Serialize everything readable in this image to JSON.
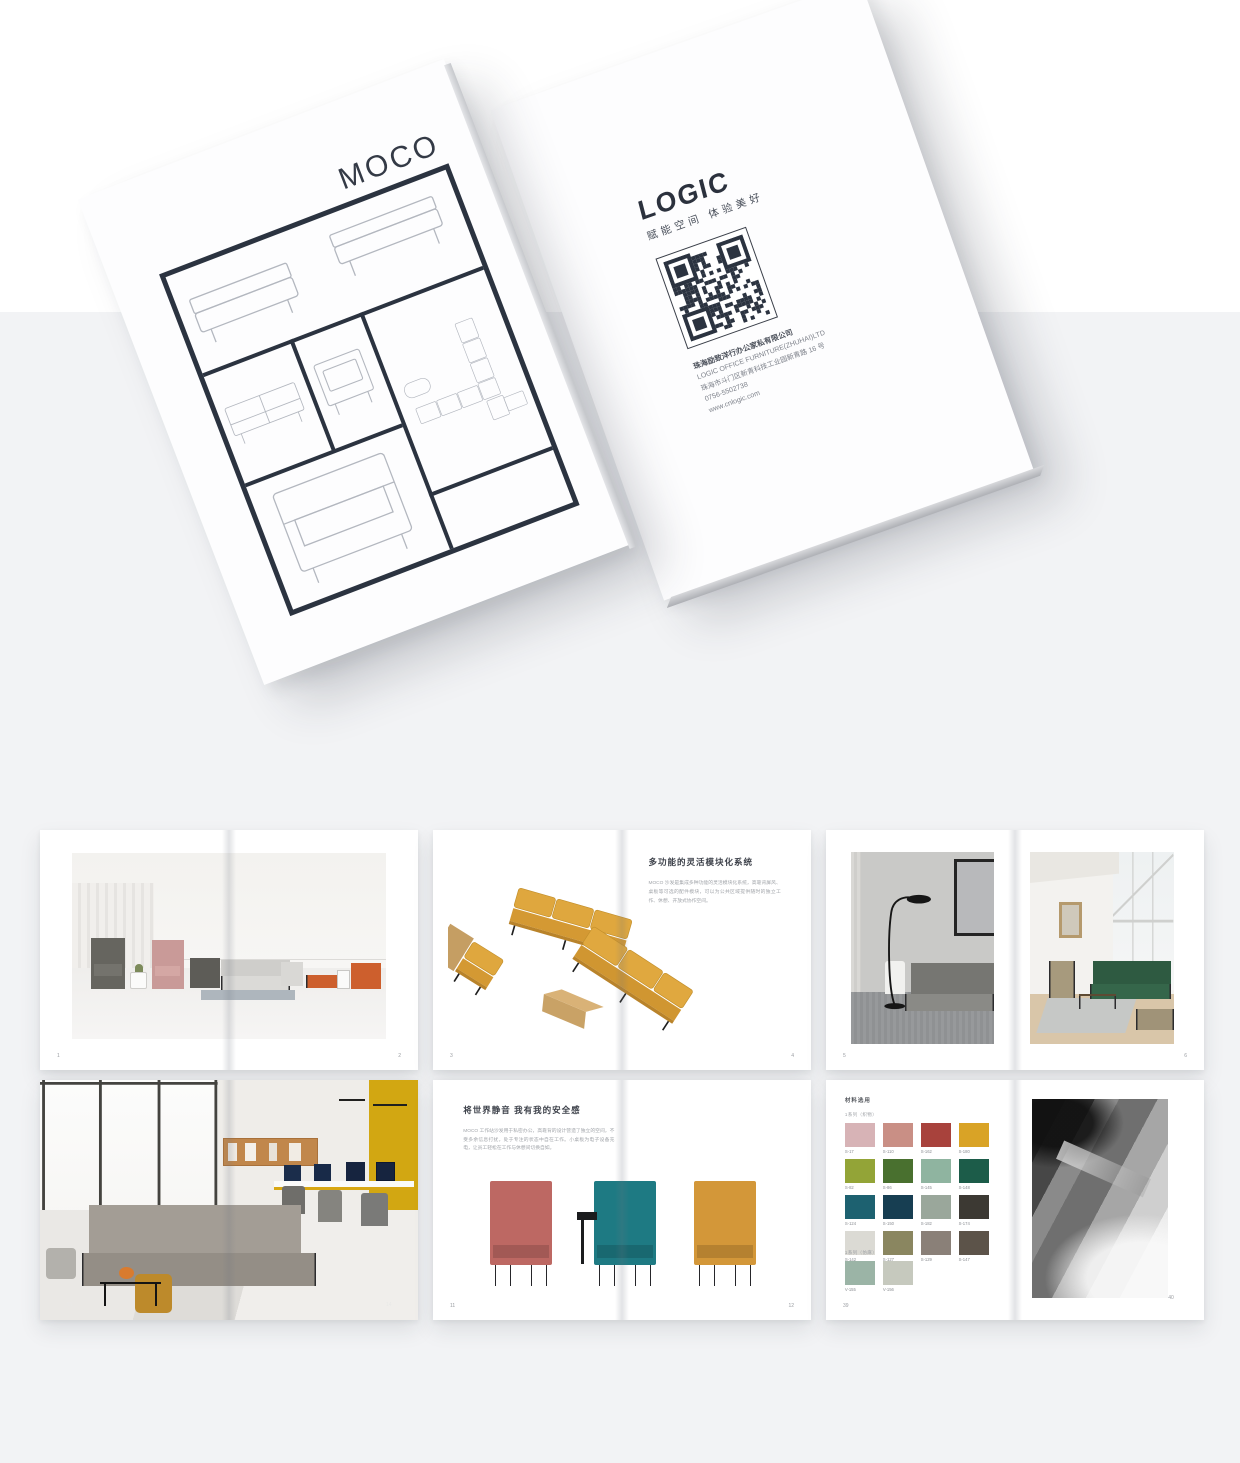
{
  "hero": {
    "front_cover": {
      "title": "MOCO"
    },
    "back_cover": {
      "logo": "LOGIC",
      "tagline": "赋能空间 体验美好",
      "company_cn": "珠海励致洋行办公家私有限公司",
      "company_en": "LOGIC OFFICE FURNITURE(ZHUHAI)LTD",
      "address": "珠海市斗门区新青科技工业园新青路 16 号",
      "phone": "0756-5502738",
      "website": "www.cnlogic.com"
    }
  },
  "spreads": {
    "showroom": {
      "page_left": "1",
      "page_right": "2"
    },
    "modular": {
      "heading": "多功能的灵活模块化系统",
      "body": "MOCO 沙发是集成多种功能的灵活模块化系统，高靠背屏风、桌板等可选的配件模块，可以为公共区域提供随时的独立工作、休憩、开放式协作空间。",
      "page_left": "3",
      "page_right": "4"
    },
    "scenes": {
      "page_left": "5",
      "page_right": "6"
    },
    "office": {
      "page_left": "13",
      "page_right": "14"
    },
    "privacy": {
      "heading": "将世界静音 我有我的安全感",
      "body": "MOCO 工作站沙发用于私密办公，高靠背的设计营造了独立的空间，不受多余信息打扰，处于专注的状态中自在工作。小桌板为电子设备充电，让员工轻松在工作与休憩间切换自如。",
      "chairs": [
        {
          "name": "rose high-back chair",
          "color": "#BD6863"
        },
        {
          "name": "teal high-back chair with tablet",
          "color": "#1E7A83"
        },
        {
          "name": "mustard high-back chair",
          "color": "#D39739"
        }
      ],
      "page_left": "11",
      "page_right": "12"
    },
    "materials": {
      "header": "材料选用",
      "group1_label": "1系列（织物）",
      "group2_label": "1系列（仿麻）",
      "swatches": [
        {
          "code": "S-17",
          "color": "#D7B3B6"
        },
        {
          "code": "S-110",
          "color": "#C98F85"
        },
        {
          "code": "S-162",
          "color": "#A8423C"
        },
        {
          "code": "S-180",
          "color": "#D9A326"
        },
        {
          "code": "S-82",
          "color": "#93A437"
        },
        {
          "code": "S-86",
          "color": "#49702F"
        },
        {
          "code": "S-145",
          "color": "#8FB4A0"
        },
        {
          "code": "S-148",
          "color": "#1C5C49"
        },
        {
          "code": "S-124",
          "color": "#1D6170"
        },
        {
          "code": "S-150",
          "color": "#173E52"
        },
        {
          "code": "S-182",
          "color": "#9AA79B"
        },
        {
          "code": "S-174",
          "color": "#3C3933"
        },
        {
          "code": "S-142",
          "color": "#DBDAD4"
        },
        {
          "code": "S-127",
          "color": "#8A8660"
        },
        {
          "code": "S-129",
          "color": "#8A8078"
        },
        {
          "code": "S-147",
          "color": "#5C5349"
        }
      ],
      "swatches2": [
        {
          "code": "V-155",
          "color": "#9BB4A6"
        },
        {
          "code": "V-156",
          "color": "#C6C9BE"
        }
      ],
      "page_left": "39",
      "page_right": "40"
    }
  },
  "colors": {
    "accent_mustard": "#D9A326",
    "navy_frame": "#2B3340",
    "background_gray": "#F2F3F5",
    "orange_sofa": "#CD5F2D",
    "pink_chair": "#C99A98",
    "green_sofa": "#2E5A41"
  }
}
